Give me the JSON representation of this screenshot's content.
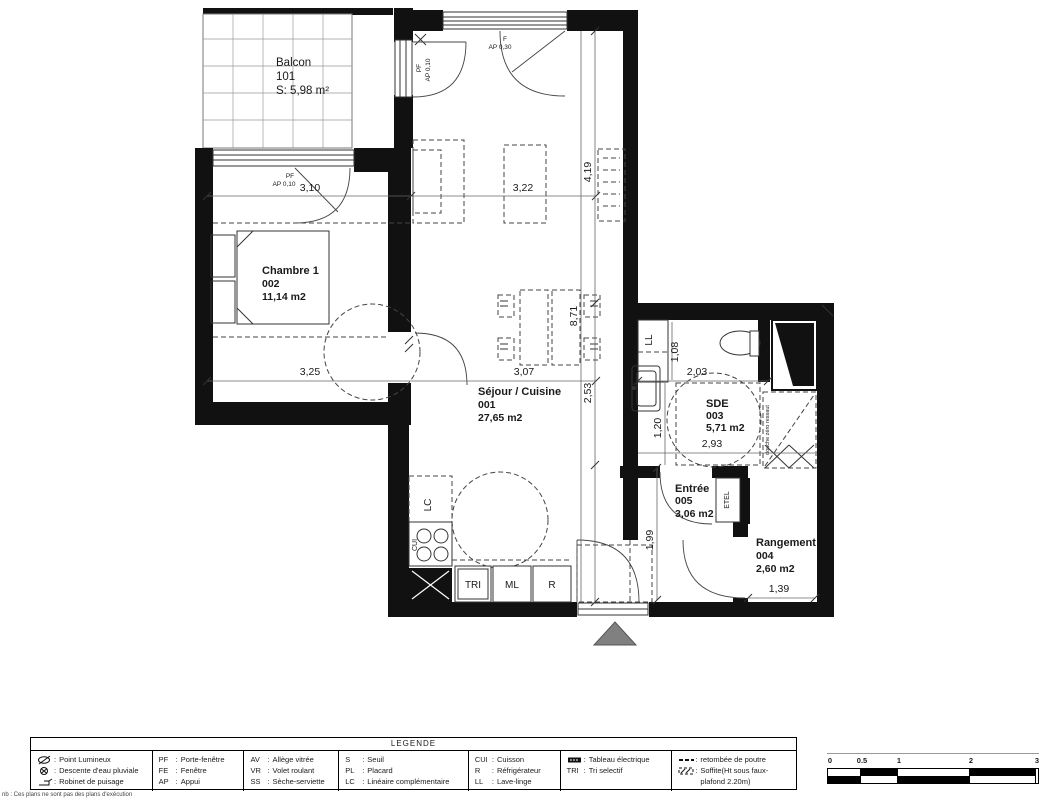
{
  "plan": {
    "balcon": {
      "name": "Balcon",
      "number": "101",
      "area": "S: 5,98 m²"
    },
    "chambre": {
      "name": "Chambre 1",
      "number": "002",
      "area": "11,14 m2"
    },
    "sejour": {
      "name": "Séjour / Cuisine",
      "number": "001",
      "area": "27,65 m2"
    },
    "sde": {
      "name": "SDE",
      "number": "003",
      "area": "5,71 m2"
    },
    "entree": {
      "name": "Entrée",
      "number": "005",
      "area": "3,06 m2"
    },
    "rangement": {
      "name": "Rangement",
      "number": "004",
      "area": "2,60 m2"
    },
    "dims": {
      "chambre_width": "3,10",
      "sejour_width": "3,22",
      "sejour_h_top": "4,19",
      "sejour_h_total": "8,71",
      "sejour_h_mid": "2,53",
      "chambre_width2": "3,25",
      "sejour_width2": "3,07",
      "ll_height": "1,08",
      "sde_width": "2,03",
      "sde_height": "1,20",
      "sde_width2": "2,93",
      "entree_height": "1,99",
      "rangement_width": "1,39"
    },
    "openings": {
      "pf": "PF",
      "ap010": "AP 0,10",
      "f": "F",
      "ap030": "AP 0,30"
    },
    "fixtures": {
      "ll": "LL",
      "lc": "LC",
      "cui": "CUI",
      "tri": "TRI",
      "ml": "ML",
      "r": "R",
      "etel": "ETEL",
      "douche": "douche zéro ressaut"
    }
  },
  "legend": {
    "title": "LEGENDE",
    "sep": ":",
    "cols": [
      {
        "items": [
          {
            "label": "Point Lumineux"
          },
          {
            "label": "Descente d'eau pluviale"
          },
          {
            "label": "Robinet de puisage"
          }
        ]
      },
      {
        "items": [
          {
            "abbr": "PF",
            "label": "Porte-fenêtre"
          },
          {
            "abbr": "FE",
            "label": "Fenêtre"
          },
          {
            "abbr": "AP",
            "label": "Appui"
          }
        ]
      },
      {
        "items": [
          {
            "abbr": "AV",
            "label": "Allège vitrée"
          },
          {
            "abbr": "VR",
            "label": "Volet roulant"
          },
          {
            "abbr": "SS",
            "label": "Sèche-serviette"
          }
        ]
      },
      {
        "items": [
          {
            "abbr": "S",
            "label": "Seuil"
          },
          {
            "abbr": "PL",
            "label": "Placard"
          },
          {
            "abbr": "LC",
            "label": "Linéaire complémentaire"
          }
        ]
      },
      {
        "items": [
          {
            "abbr": "CUI",
            "label": "Cuisson"
          },
          {
            "abbr": "R",
            "label": "Réfrigérateur"
          },
          {
            "abbr": "LL",
            "label": "Lave-linge"
          }
        ]
      },
      {
        "items": [
          {
            "label": "Tableau électrique"
          },
          {
            "abbr": "TRI",
            "label": "Tri selectif"
          }
        ]
      },
      {
        "items": [
          {
            "label": "retombée de poutre"
          },
          {
            "label": "Soffite(Ht sous faux-plafond 2.20m)"
          }
        ]
      }
    ]
  },
  "scalebar": {
    "labels": [
      "0",
      "0.5",
      "1",
      "2",
      "3"
    ]
  },
  "footnote": "nb : Ces plans ne sont pas des plans d'exécution"
}
